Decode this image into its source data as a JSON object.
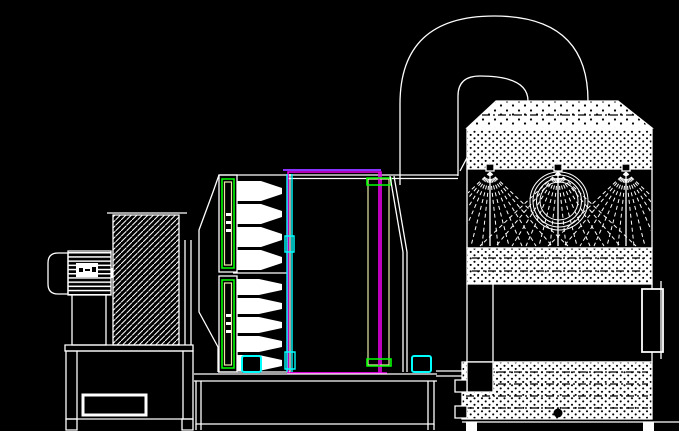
{
  "title": "CAD elevation drawing: size-reduction machine with air duct and spray scrubber tower",
  "canvas": {
    "width": 679,
    "height": 431,
    "background": "#000000"
  },
  "palette": {
    "line": "#ffffff",
    "green": "#00ff00",
    "cyan": "#00ffff",
    "magenta": "#ee00ee",
    "purple": "#8833ff",
    "tan": "#e8e8a8",
    "black": "#000000"
  },
  "components": {
    "motor": "electric motor",
    "fan_cover": "motor fan cover",
    "nameplate": "motor nameplate",
    "belt_guard": "belt guard (hatched)",
    "motor_base": "motor base frame",
    "knife_bar_upper": "upper knife bar",
    "knife_bar_lower": "lower knife bar",
    "rotor_teeth": "rotor teeth",
    "cutting_chamber": "cutting chamber",
    "screen_column": "discharge screen column",
    "machine_base": "machine base frame",
    "feet": "machine feet",
    "duct": "air duct 180-degree bend",
    "tower": "spray scrubber tower",
    "roof": "tower roof (dotted)",
    "nozzles": "spray nozzles",
    "sight_ring": "sight ring",
    "mid_section": "tower mid section",
    "access_panel": "side access panel",
    "water_tank": "water tank",
    "drain": "drain plug",
    "tank_fittings": "tank fittings",
    "tower_legs": "tower legs"
  },
  "counts": {
    "spray_nozzles": 3,
    "knife_bars": 2,
    "rotor_teeth_upper": 4,
    "rotor_teeth_lower": 5
  }
}
